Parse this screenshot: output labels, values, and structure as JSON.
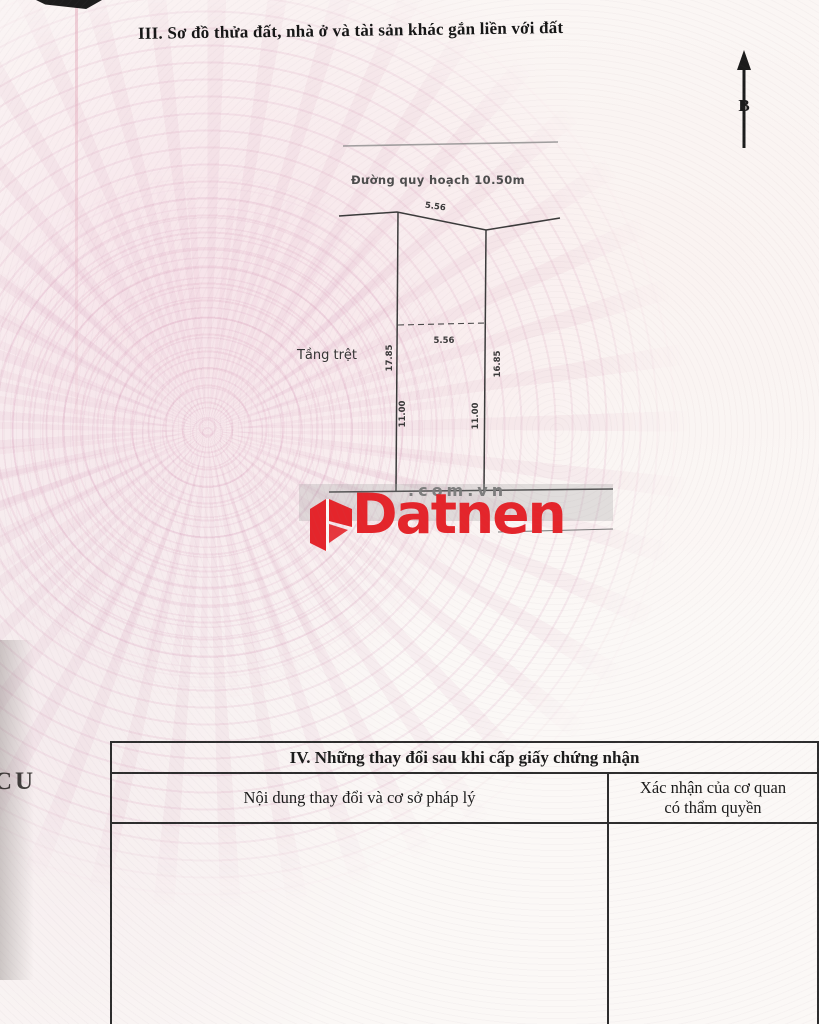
{
  "document": {
    "section_iii_title": "III. Sơ đồ thửa đất, nhà ở và tài sản khác gắn liền với đất",
    "compass_label": "B",
    "left_edge_fragment": "CU"
  },
  "plot_diagram": {
    "road_label": "Đường quy hoạch 10.50m",
    "ground_floor_label": "Tầng trệt",
    "dimensions": {
      "front_width": "5.56",
      "inner_width": "5.56",
      "left_side": "17.85",
      "right_side": "16.85",
      "left_lower": "11.00",
      "right_lower": "11.00"
    }
  },
  "watermark": {
    "brand": "Datnen",
    "suffix": ".com.vn"
  },
  "section_iv": {
    "title": "IV. Những thay đổi sau khi cấp giấy chứng nhận",
    "columns": {
      "left": "Nội dung thay đổi và cơ sở pháp lý",
      "right_line1": "Xác nhận của cơ quan",
      "right_line2": "có thẩm quyền"
    }
  },
  "colors": {
    "watermark_red": "#e4252b",
    "watermark_gray": "#7d7d7d",
    "diagram_line": "#3a3a3a",
    "table_border": "#2d2d2d"
  }
}
